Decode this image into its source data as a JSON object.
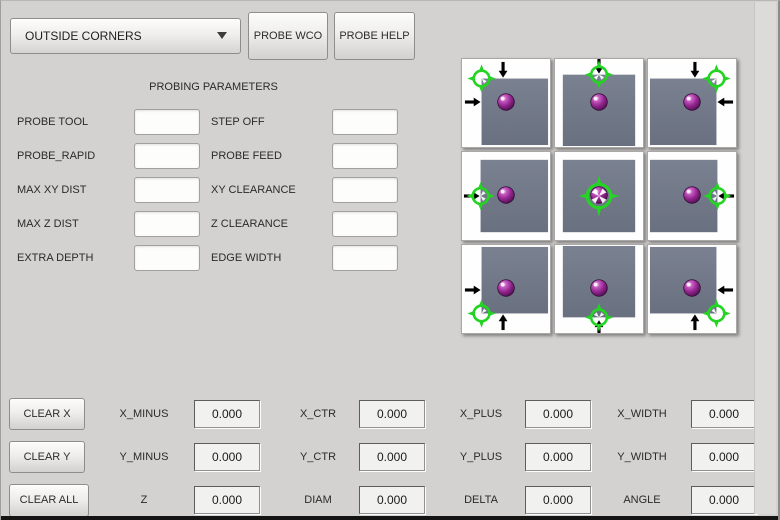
{
  "mode_selector": {
    "value": "OUTSIDE CORNERS"
  },
  "top_buttons": {
    "probe_wco": "PROBE WCO",
    "probe_help": "PROBE HELP"
  },
  "parameters": {
    "title": "PROBING PARAMETERS",
    "left": [
      {
        "label": "PROBE TOOL",
        "value": ""
      },
      {
        "label": "PROBE_RAPID",
        "value": ""
      },
      {
        "label": "MAX XY DIST",
        "value": ""
      },
      {
        "label": "MAX Z DIST",
        "value": ""
      },
      {
        "label": "EXTRA DEPTH",
        "value": ""
      }
    ],
    "right": [
      {
        "label": "STEP OFF",
        "value": ""
      },
      {
        "label": "PROBE FEED",
        "value": ""
      },
      {
        "label": "XY CLEARANCE",
        "value": ""
      },
      {
        "label": "Z CLEARANCE",
        "value": ""
      },
      {
        "label": "EDGE WIDTH",
        "value": ""
      }
    ]
  },
  "probe_diagram": {
    "colors": {
      "workpiece_gray": "#707785",
      "target_green": "#24d324",
      "ball_purple": "#93258f",
      "arrow_black": "#000000"
    },
    "cells": [
      {
        "position": "top-left",
        "arrows": [
          "down",
          "right"
        ]
      },
      {
        "position": "top-center",
        "arrows": [
          "down"
        ]
      },
      {
        "position": "top-right",
        "arrows": [
          "down",
          "left"
        ]
      },
      {
        "position": "middle-left",
        "arrows": [
          "right"
        ]
      },
      {
        "position": "center",
        "arrows": []
      },
      {
        "position": "middle-right",
        "arrows": [
          "left"
        ]
      },
      {
        "position": "bottom-left",
        "arrows": [
          "up",
          "right"
        ]
      },
      {
        "position": "bottom-center",
        "arrows": [
          "up"
        ]
      },
      {
        "position": "bottom-right",
        "arrows": [
          "up",
          "left"
        ]
      }
    ]
  },
  "clear_buttons": [
    {
      "label": "CLEAR X"
    },
    {
      "label": "CLEAR Y"
    },
    {
      "label": "CLEAR ALL"
    }
  ],
  "results": {
    "rows": [
      [
        {
          "label": "X_MINUS",
          "value": "0.000"
        },
        {
          "label": "X_CTR",
          "value": "0.000"
        },
        {
          "label": "X_PLUS",
          "value": "0.000"
        },
        {
          "label": "X_WIDTH",
          "value": "0.000"
        }
      ],
      [
        {
          "label": "Y_MINUS",
          "value": "0.000"
        },
        {
          "label": "Y_CTR",
          "value": "0.000"
        },
        {
          "label": "Y_PLUS",
          "value": "0.000"
        },
        {
          "label": "Y_WIDTH",
          "value": "0.000"
        }
      ],
      [
        {
          "label": "Z",
          "value": "0.000"
        },
        {
          "label": "DIAM",
          "value": "0.000"
        },
        {
          "label": "DELTA",
          "value": "0.000"
        },
        {
          "label": "ANGLE",
          "value": "0.000"
        }
      ]
    ]
  }
}
